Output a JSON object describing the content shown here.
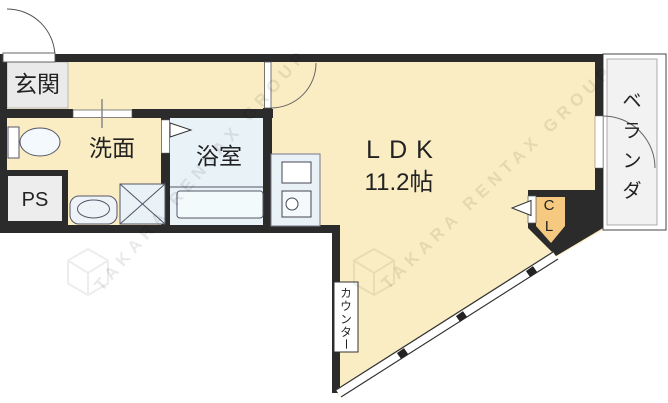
{
  "rooms": {
    "genkan": "玄関",
    "senmen": "洗面",
    "yokushitsu": "浴室",
    "ps": "PS",
    "ldk": "LDK",
    "ldk_size": "11.2帖",
    "veranda_chars": [
      "ベ",
      "ラ",
      "ン",
      "ダ"
    ],
    "closet_chars": [
      "C",
      "L"
    ],
    "counter_chars": [
      "カ",
      "ウ",
      "ン",
      "タ",
      "ー"
    ]
  },
  "watermark": {
    "text": "TAKARA RENTAX GROUP"
  },
  "colors": {
    "room_fill": "#FAEDC3",
    "closet_fill": "#F6C981",
    "wet_area_fill": "#E8F2F7",
    "genkan_fill": "#EAEAEA",
    "ps_fill": "#EDEDED",
    "veranda_fill": "#F2F2F2",
    "wall": "#2B2B2B"
  }
}
